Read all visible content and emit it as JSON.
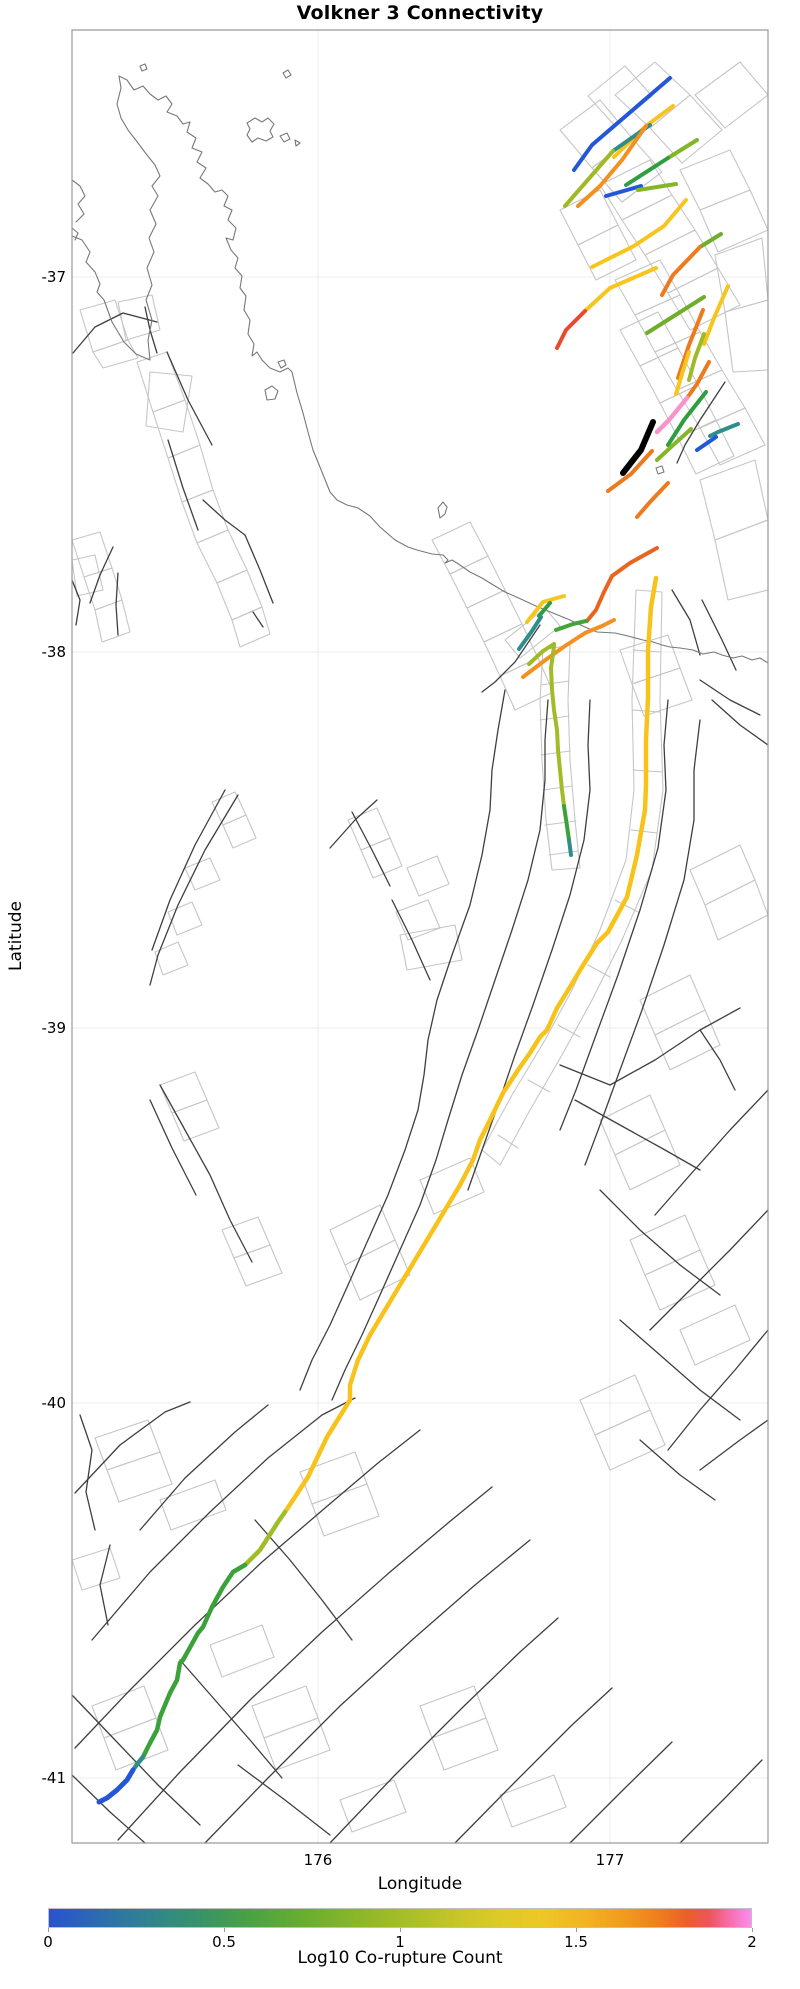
{
  "title": "Volkner 3 Connectivity",
  "axes": {
    "xlabel": "Longitude",
    "ylabel": "Latitude",
    "xticks": [
      {
        "label": "176",
        "x": 318
      },
      {
        "label": "177",
        "x": 610
      }
    ],
    "yticks": [
      {
        "label": "-37",
        "y": 277
      },
      {
        "label": "-38",
        "y": 652
      },
      {
        "label": "-39",
        "y": 1028
      },
      {
        "label": "-40",
        "y": 1403
      },
      {
        "label": "-41",
        "y": 1778
      }
    ],
    "plot_box": {
      "left": 72,
      "top": 30,
      "right": 768,
      "bottom": 1843
    }
  },
  "colorbar": {
    "label": "Log10 Co-rupture Count",
    "min": 0,
    "max": 2,
    "x": 48,
    "y": 1908,
    "width": 704,
    "height": 20,
    "ticks": [
      {
        "label": "0",
        "value": 0
      },
      {
        "label": "0.5",
        "value": 0.5
      },
      {
        "label": "1",
        "value": 1
      },
      {
        "label": "1.5",
        "value": 1.5
      },
      {
        "label": "2",
        "value": 2
      }
    ],
    "gradient": [
      [
        0,
        "#2a52d0"
      ],
      [
        0.05,
        "#2b64ba"
      ],
      [
        0.11,
        "#2e7a9f"
      ],
      [
        0.17,
        "#318b82"
      ],
      [
        0.23,
        "#3a9760"
      ],
      [
        0.29,
        "#4ba343"
      ],
      [
        0.36,
        "#68ad2f"
      ],
      [
        0.43,
        "#87b52a"
      ],
      [
        0.5,
        "#a3bd28"
      ],
      [
        0.57,
        "#c2c42a"
      ],
      [
        0.64,
        "#dcca29"
      ],
      [
        0.7,
        "#edc726"
      ],
      [
        0.76,
        "#f3b422"
      ],
      [
        0.82,
        "#f29a20"
      ],
      [
        0.87,
        "#ef7d1e"
      ],
      [
        0.91,
        "#ea5f28"
      ],
      [
        0.94,
        "#ec555b"
      ],
      [
        0.97,
        "#f46fae"
      ],
      [
        1,
        "#fb8cf0"
      ]
    ]
  },
  "palette": {
    "mesh": "#c6c6c6",
    "fault": "#3f3f3f",
    "coast": "#787878",
    "grid": "#ececec",
    "spine": "#9a9a9a",
    "background": "#ffffff"
  },
  "map": {
    "coastline": [
      "M72,236 L82,240 L90,252 L86,262 L95,272 L100,284 L97,292 L104,300 L112,322 L124,342 L136,354 L150,360 L148,340 L152,320 L146,300 L152,285 L147,268 L154,252 L149,238 L156,224 L150,210 L158,196 L152,186 L160,176 L155,165 L147,155 L138,143 L128,130 L121,118 L117,104 L121,88 L119,76 L127,80 L134,90 L143,86 L150,94 L158,100 L166,96 L172,104 L167,112 L177,116 L183,124 L190,122 L187,132 L196,138 L192,148 L202,152 L197,162 L206,168 L200,178 L208,184 L215,192 L222,190 L228,196 L224,206 L232,210 L228,220 L236,228 L233,240 L226,238 L231,250 L238,258 L235,268 L242,276 L240,288 L246,296 L244,310 L250,320 L248,334 L254,344 L252,356 L257,352 L262,360 L270,368 L280,372 L288,368 L292,372 L297,393 L303,413 L308,432 L313,450 L322,472 L330,492 L337,500 L347,505 L358,508 L370,516 L380,527 L395,540 L408,547 L417,550 L432,554 L443,555 L448,560 L445,563 L452,560 L457,563 L470,572 L482,578 L490,583 L505,592 L523,600 L538,607 L553,613 L570,620 L585,627 L597,632 L615,633 L628,636 L643,640 L653,642 L662,645 L670,647 L680,648 L693,650 L703,654 L714,652 L722,655 L733,658 L742,656 L752,660 L760,658 L768,663",
      "M72,180 L80,186 L85,196 L78,204 L84,214 L76,222",
      "M72,228 L78,233 L75,240"
    ],
    "islands": [
      "M247,123 L255,118 L262,122 L268,118 L274,124 L270,131 L273,137 L266,141 L258,138 L252,142 L247,135 L250,129 Z",
      "M283,73 L288,70 L291,75 L286,78 Z",
      "M140,66 L145,64 L147,69 L142,71 Z",
      "M280,136 L287,133 L290,139 L284,142 Z",
      "M295,140 L300,143 L296,146 Z",
      "M265,390 L272,386 L278,391 L275,399 L267,400 Z",
      "M278,362 L284,360 L286,365 L281,368 Z",
      "M438,508 L443,502 L447,507 L445,514 L440,518 Z",
      "M656,468 L662,466 L664,472 L658,474 Z"
    ],
    "mesh": [
      "M137,362 L167,352 L185,400 L153,412 Z",
      "M153,412 L185,400 L200,445 L168,458 Z",
      "M168,458 L200,445 L213,490 L182,502 Z",
      "M182,502 L213,490 L228,530 L197,543 Z",
      "M150,372 L192,376 L183,432 L146,426 Z",
      "M197,543 L228,530 L247,570 L217,583 Z",
      "M217,583 L247,570 L262,607 L232,620 Z",
      "M232,620 L262,607 L270,634 L240,647 Z",
      "M72,540 L100,532 L112,568 L84,577 Z",
      "M84,577 L112,568 L122,600 L95,610 Z",
      "M95,610 L122,600 L130,632 L102,642 Z",
      "M72,560 L95,555 L103,590 L77,596 Z",
      "M80,310 L115,300 L128,340 L93,352 Z",
      "M93,352 L128,340 L138,358 L103,368 Z",
      "M118,302 L152,295 L160,330 L126,340 Z",
      "M615,95 L655,62 L690,95 L650,128 Z",
      "M650,128 L690,95 L722,130 L682,163 Z",
      "M695,95 L740,62 L768,95 L725,128 Z",
      "M588,96 L625,66 L652,96 L615,126 Z",
      "M560,130 L600,100 L632,138 L592,168 Z",
      "M592,168 L632,138 L662,172 L622,202 Z",
      "M600,185 L650,160 L672,195 L622,220 Z",
      "M622,220 L672,195 L695,230 L645,255 Z",
      "M680,170 L730,150 L750,190 L700,210 Z",
      "M700,210 L750,190 L768,230 L718,252 Z",
      "M645,255 L695,230 L718,268 L668,293 Z",
      "M668,293 L718,268 L740,305 L690,330 Z",
      "M615,280 L660,260 L680,295 L635,315 Z",
      "M635,315 L680,295 L700,332 L655,352 Z",
      "M655,352 L700,332 L722,370 L677,390 Z",
      "M677,390 L722,370 L745,408 L700,428 Z",
      "M700,428 L745,408 L765,445 L720,465 Z",
      "M620,330 L658,312 L678,348 L640,366 Z",
      "M640,366 L678,348 L698,385 L660,403 Z",
      "M660,403 L698,385 L716,420 L678,438 Z",
      "M678,438 L716,420 L734,456 L696,474 Z",
      "M560,210 L600,190 L618,225 L578,245 Z",
      "M578,245 L618,225 L636,260 L596,280 Z",
      "M715,255 L762,238 L768,300 L725,312 Z",
      "M725,312 L768,300 L768,370 L733,372 Z",
      "M700,480 L755,460 L768,520 L715,540 Z",
      "M715,540 L768,520 L768,590 L728,600 Z",
      "M432,540 L470,522 L488,556 L450,574 Z",
      "M450,574 L488,556 L505,590 L467,608 Z",
      "M467,608 L505,590 L522,624 L484,642 Z",
      "M484,642 L522,624 L538,658 L500,676 Z",
      "M500,676 L538,658 L553,692 L515,710 Z",
      "M505,640 L545,608 L560,626 L520,658 Z",
      "M620,650 L668,635 L680,668 L632,684 Z",
      "M632,684 L680,668 L692,700 L644,716 Z",
      "M543,650 L540,700 L542,760 L546,820 L552,870 M570,645 L568,700 L570,760 L575,820 L580,868 M543,650 L570,645 M541,685 L569,681 M540,720 L569,716 M541,755 L570,751 M543,790 L572,786 M545,825 L576,821 M549,855 L578,851 M552,870 L580,868",
      "M636,590 L632,700 L634,790 L626,860 L600,930 L572,990 L545,1040 L512,1095 L482,1150 M662,592 L660,700 L663,790 L652,870 L622,940 L592,1000 L562,1055 L530,1110 L500,1165 M636,590 L662,592 M633,650 L661,652 M632,710 L660,712 M633,770 L662,772 M631,830 L657,833 M615,900 L638,912 M588,965 L610,977 M558,1025 L580,1037 M528,1080 L550,1092 M498,1135 L518,1148 M482,1150 L500,1165",
      "M690,870 L740,845 L755,880 L705,905 Z",
      "M705,905 L755,880 L768,915 L718,940 Z",
      "M640,1000 L690,975 L705,1010 L655,1035 Z",
      "M655,1035 L705,1010 L720,1045 L670,1070 Z",
      "M600,1120 L650,1095 L665,1130 L615,1155 Z",
      "M615,1155 L665,1130 L680,1165 L630,1190 Z",
      "M630,1240 L685,1215 L700,1250 L645,1275 Z",
      "M645,1275 L700,1250 L715,1285 L660,1310 Z",
      "M680,1330 L735,1305 L750,1340 L695,1365 Z",
      "M580,1400 L635,1375 L650,1410 L595,1435 Z",
      "M595,1435 L650,1410 L665,1445 L610,1470 Z",
      "M348,820 L377,808 L390,838 L361,850 Z",
      "M361,850 L390,838 L402,866 L373,878 Z",
      "M407,868 L437,856 L449,884 L419,896 Z",
      "M396,912 L428,900 L440,928 L408,940 Z",
      "M400,935 L455,925 L462,960 L407,970 Z",
      "M212,802 L235,792 L246,815 L223,825 Z",
      "M223,825 L246,815 L256,838 L233,848 Z",
      "M185,868 L210,858 L220,880 L195,890 Z",
      "M168,912 L192,902 L202,925 L177,935 Z",
      "M155,952 L178,942 L188,965 L163,975 Z",
      "M160,1085 L195,1072 L207,1100 L172,1113 Z",
      "M172,1113 L207,1100 L219,1128 L184,1141 Z",
      "M222,1230 L258,1217 L270,1245 L234,1258 Z",
      "M234,1258 L270,1245 L282,1273 L246,1286 Z",
      "M330,1230 L380,1205 L395,1240 L345,1265 Z",
      "M345,1265 L395,1240 L410,1275 L360,1300 Z",
      "M420,1180 L470,1158 L484,1192 L434,1214 Z",
      "M95,1438 L148,1420 L160,1452 L107,1470 Z",
      "M107,1470 L160,1452 L172,1484 L119,1502 Z",
      "M300,1472 L355,1452 L367,1484 L312,1504 Z",
      "M312,1504 L367,1484 L379,1516 L324,1536 Z",
      "M210,1645 L262,1625 L274,1657 L222,1677 Z",
      "M92,1706 L144,1686 L156,1718 L104,1738 Z",
      "M104,1738 L156,1718 L168,1750 L116,1770 Z",
      "M252,1706 L306,1686 L318,1718 L264,1738 Z",
      "M264,1738 L318,1718 L330,1750 L276,1770 Z",
      "M420,1706 L474,1686 L486,1718 L432,1738 Z",
      "M432,1738 L486,1718 L498,1750 L444,1770 Z",
      "M340,1800 L394,1780 L406,1812 L352,1832 Z",
      "M500,1795 L554,1775 L566,1807 L512,1827 Z",
      "M72,1560 L110,1548 L120,1578 L82,1590 Z",
      "M160,1500 L215,1480 L226,1510 L171,1530 Z"
    ],
    "faults": [
      "M167,352 L188,400 L212,445",
      "M168,440 L183,488 L198,530",
      "M203,500 L225,520 L245,535",
      "M245,535 L260,570 L273,603",
      "M253,612 L263,627",
      "M145,307 L150,330 L157,353",
      "M73,353 L95,327 L123,313 L157,322",
      "M113,547 L100,575 L90,603",
      "M118,573 L116,605 L118,635",
      "M72,580 L80,600 L76,625",
      "M238,795 L205,850 L178,905 L158,955 L150,985",
      "M225,790 L195,845 L170,900 L152,950",
      "M330,848 L355,820 L377,800",
      "M352,812 L372,850 L390,886",
      "M392,900 L412,940 L430,980",
      "M540,625 L515,662 L495,682 L482,692",
      "M505,690 L498,730 L492,770 L490,810 L482,855 L470,905 L452,955 L437,1000 L428,1040 L424,1075 L418,1110 L405,1150 L388,1195 L368,1240 L348,1285 L330,1325 L312,1360 L300,1390",
      "M548,700 L545,740 L545,780 L540,830 L528,880 L512,930 L495,980 L478,1030 L462,1075 L448,1120 L436,1160 L420,1205 L400,1250 L380,1295 L362,1335 L345,1370 L332,1400",
      "M590,700 L588,745 L590,790 L584,840 L570,895 L552,950 L533,1005 L515,1055 L498,1105 L482,1150 L468,1190",
      "M668,700 L664,745 L666,790 L658,848 L640,910 L618,975 L596,1035 L576,1090 L560,1130",
      "M700,720 L694,770 L694,820 L684,880 L664,945 L642,1010 L620,1070 L600,1125 L585,1165",
      "M672,590 L690,620 L700,655",
      "M702,600 L722,640 L736,670",
      "M700,680 L730,700 L760,715",
      "M712,700 L740,725 L768,745",
      "M725,382 L700,420 L685,445 L677,463",
      "M560,1065 L610,1085 L655,1060 L700,1030 L740,1008",
      "M575,1100 L620,1125 L665,1150 L700,1170",
      "M700,1030 L720,1060 L735,1090",
      "M768,1090 L730,1130 L690,1175 L655,1215",
      "M600,1190 L640,1230 L680,1265 L720,1295",
      "M768,1210 L730,1250 L690,1290 L650,1330",
      "M620,1320 L660,1355 L700,1390 L740,1420",
      "M768,1330 L735,1370 L700,1410 L668,1450",
      "M640,1440 L680,1475 L715,1500",
      "M700,1470 L740,1440 L768,1420",
      "M75,1493 L120,1445 L165,1412 L190,1402",
      "M140,1530 L185,1478 L235,1432 L268,1405",
      "M92,1640 L150,1572 L210,1512 L268,1458 L322,1415 L355,1398",
      "M75,1748 L130,1690 L195,1625 L262,1562 L325,1508 L378,1463 L420,1430",
      "M118,1840 L180,1772 L250,1700 L322,1632 L390,1572 L448,1523 L492,1487",
      "M205,1843 L268,1778 L340,1706 L412,1640 L475,1585 L530,1540",
      "M330,1843 L395,1775 L462,1708 L520,1652 L558,1618",
      "M455,1843 L515,1782 L572,1725 L612,1688",
      "M570,1843 L625,1788 L672,1742",
      "M680,1843 L725,1798 L762,1760",
      "M72,1695 L115,1740 L158,1785 L200,1825",
      "M72,1775 L110,1812 L145,1843",
      "M238,1765 L285,1800 L330,1835",
      "M80,1415 L92,1450 L86,1492 L95,1530",
      "M110,1545 L100,1585 L108,1625",
      "M255,1520 L290,1560 L322,1600 L352,1640",
      "M180,1660 L215,1700 L250,1740 L282,1778",
      "M160,1085 L185,1130 L210,1175 L230,1220 L252,1262",
      "M150,1100 L172,1148 L196,1195"
    ],
    "segments": [
      {
        "name": "rupture-blue-ne",
        "color": "#2457d8",
        "width": 4,
        "d": "M670,78 L592,145 L574,170"
      },
      {
        "name": "rupture-yellow-ne",
        "color": "#f7c51e",
        "width": 4,
        "d": "M673,106 L646,126 L614,157"
      },
      {
        "name": "rupture-teal-ne",
        "color": "#2f8e8a",
        "width": 4,
        "d": "M650,125 L613,151"
      },
      {
        "name": "rupture-olive-ne",
        "color": "#a0ba25",
        "width": 4,
        "d": "M613,151 L565,206"
      },
      {
        "name": "rupture-orange-ne",
        "color": "#f29122",
        "width": 4,
        "d": "M646,126 L622,160 L600,186 L578,206"
      },
      {
        "name": "rupture-ygreen",
        "color": "#84b627",
        "width": 4,
        "d": "M697,140 L668,158"
      },
      {
        "name": "rupture-green",
        "color": "#2f9e40",
        "width": 4,
        "d": "M668,158 L626,185"
      },
      {
        "name": "rupture-blue-short",
        "color": "#2457d8",
        "width": 4,
        "d": "M606,196 L641,186"
      },
      {
        "name": "rupture-ygreen-short",
        "color": "#84b627",
        "width": 4,
        "d": "M638,190 L676,184"
      },
      {
        "name": "rupture-yellow-curve",
        "color": "#f7c51e",
        "width": 4,
        "d": "M686,200 L664,226 L634,246 L592,267"
      },
      {
        "name": "rupture-green-r",
        "color": "#6fae2b",
        "width": 4,
        "d": "M721,234 L700,247"
      },
      {
        "name": "rupture-orange-r",
        "color": "#ee7a1e",
        "width": 4,
        "d": "M700,247 L673,275 L662,295"
      },
      {
        "name": "rupture-yellow-mid",
        "color": "#f7c51e",
        "width": 4,
        "d": "M656,268 L610,288 L585,311"
      },
      {
        "name": "rupture-red",
        "color": "#e84a30",
        "width": 4,
        "d": "M585,311 L566,330 L557,348"
      },
      {
        "name": "rupture-yellow-steep",
        "color": "#f7c51e",
        "width": 4,
        "d": "M728,286 L714,318 L704,344"
      },
      {
        "name": "rupture-green-diag",
        "color": "#6fae2b",
        "width": 4,
        "d": "M704,297 L647,333"
      },
      {
        "name": "rupture-orange-steep",
        "color": "#ee7a1e",
        "width": 4,
        "d": "M703,310 L689,345 L678,378"
      },
      {
        "name": "rupture-olive-steep",
        "color": "#a0ba25",
        "width": 4,
        "d": "M704,334 L695,358 L689,380"
      },
      {
        "name": "rupture-yellow-steep2",
        "color": "#f7c51e",
        "width": 4,
        "d": "M689,352 L682,374 L676,394"
      },
      {
        "name": "rupture-orange-steep2",
        "color": "#ee7a1e",
        "width": 4,
        "d": "M709,362 L697,384 L687,398"
      },
      {
        "name": "rupture-pink",
        "color": "#fb93cb",
        "width": 4.5,
        "d": "M687,398 L669,420 L657,432"
      },
      {
        "name": "rupture-black-highlight",
        "color": "#000000",
        "width": 6,
        "d": "M653,422 L641,450 L623,473"
      },
      {
        "name": "rupture-green-s",
        "color": "#2f9e40",
        "width": 4,
        "d": "M706,392 L684,420 L668,445"
      },
      {
        "name": "rupture-ygreen-s",
        "color": "#84b627",
        "width": 4,
        "d": "M691,429 L671,447 L657,460"
      },
      {
        "name": "rupture-teal-s",
        "color": "#2f8e8a",
        "width": 4,
        "d": "M738,424 L718,432 L710,436"
      },
      {
        "name": "rupture-blue-s",
        "color": "#2457d8",
        "width": 4,
        "d": "M716,437 L697,450"
      },
      {
        "name": "rupture-orange-s1",
        "color": "#ee7a1e",
        "width": 4,
        "d": "M652,451 L631,474 L608,491"
      },
      {
        "name": "rupture-orange-s2",
        "color": "#ee7a1e",
        "width": 4,
        "d": "M668,483 L650,502 L637,517"
      },
      {
        "name": "rupture-deeporange-diag",
        "color": "#e8641f",
        "width": 4,
        "d": "M657,548 L630,563 L612,576 L604,592 L596,610 L587,621"
      },
      {
        "name": "rupture-orange-coast",
        "color": "#f29122",
        "width": 4,
        "d": "M523,677 L544,661 L565,646 L585,633 L602,626 L614,620"
      },
      {
        "name": "rupture-yellow-coast",
        "color": "#f7c51e",
        "width": 4,
        "d": "M527,622 L543,602 L564,596"
      },
      {
        "name": "rupture-green-coast",
        "color": "#2f9e40",
        "width": 4,
        "d": "M539,616 L550,603"
      },
      {
        "name": "rupture-teal-coast",
        "color": "#2f8e8a",
        "width": 4,
        "d": "M519,649 L532,631 L541,617"
      },
      {
        "name": "rupture-green-coast2",
        "color": "#45a43a",
        "width": 4,
        "d": "M556,630 L573,624 L586,621"
      },
      {
        "name": "rupture-olive-coast",
        "color": "#a0ba25",
        "width": 4,
        "d": "M529,664 L543,651 L554,644"
      },
      {
        "name": "rupture-olive-long",
        "color": "#a2bc28",
        "width": 4,
        "d": "M554,646 L551,668 L552,690 L554,710 L557,730 L558,750 L560,770 L562,790 L564,806"
      },
      {
        "name": "rupture-olive-long-green",
        "color": "#3aa238",
        "width": 4,
        "d": "M564,806 L567,826 L569,840"
      },
      {
        "name": "rupture-olive-long-teal",
        "color": "#2f8e8a",
        "width": 4,
        "d": "M569,840 L571,855"
      },
      {
        "name": "rupture-main-yellow",
        "color": "#f7c31b",
        "width": 4.5,
        "d": "M656,578 L651,607 L648,650 L648,697 L646,740 L646,785 L645,810 L637,855 L627,897 L608,932 L597,943 L582,967 L570,987 L557,1008 L547,1030 L540,1037 L530,1053 L518,1070 L503,1093 L490,1120 L480,1140 L473,1160 L460,1185 L445,1210 L430,1235 L415,1260 L400,1285 L385,1310 L370,1335 L358,1360 L350,1385 L350,1400 L327,1437 L308,1477 L293,1500 L285,1512"
      },
      {
        "name": "rupture-main-ygreen",
        "color": "#9ebd27",
        "width": 4.5,
        "d": "M285,1512 L278,1522 L260,1550 L245,1565"
      },
      {
        "name": "rupture-main-green",
        "color": "#3aa238",
        "width": 4.5,
        "d": "M245,1565 L233,1572 L223,1587 L212,1607 L203,1627 L198,1633 L183,1660 L180,1663 L177,1680 L170,1693 L160,1717 L157,1730 L150,1743 L143,1757"
      },
      {
        "name": "rupture-main-teal",
        "color": "#2f8e8a",
        "width": 4.5,
        "d": "M143,1757 L138,1763 L133,1770"
      },
      {
        "name": "rupture-main-blue",
        "color": "#2457d8",
        "width": 5,
        "d": "M133,1770 L127,1780 L117,1790 L107,1798 L99,1802"
      }
    ]
  }
}
